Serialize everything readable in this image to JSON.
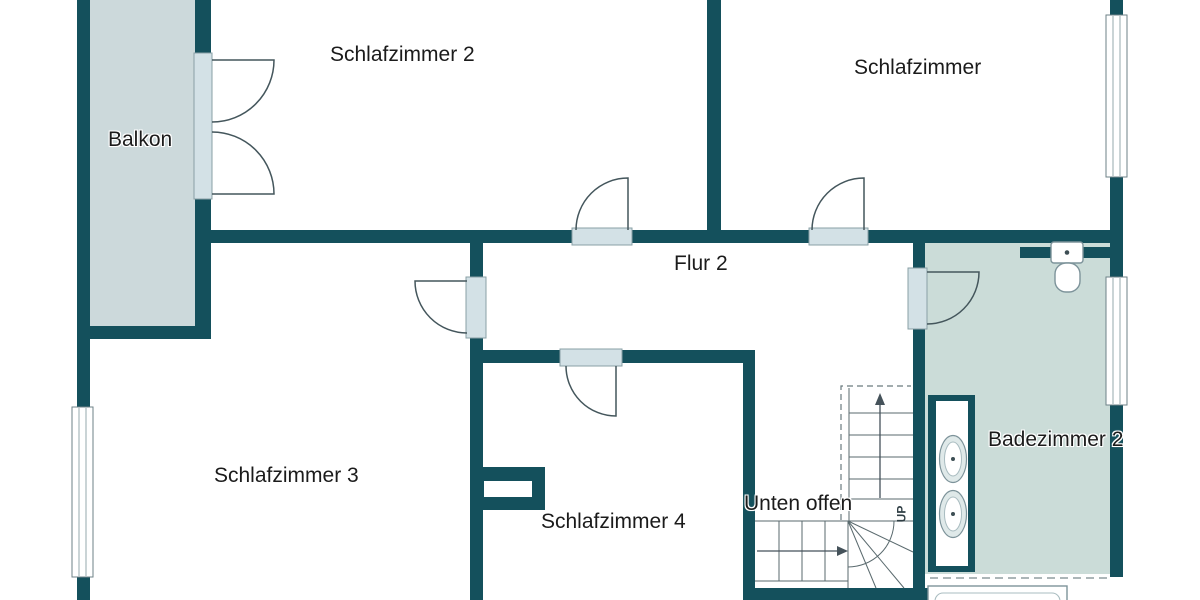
{
  "title": "Obergeschoss Grundriss (Ausschnitt)",
  "rooms": {
    "balkon": {
      "label": "Balkon"
    },
    "schlafzimmer2": {
      "label": "Schlafzimmer 2"
    },
    "schlafzimmer": {
      "label": "Schlafzimmer"
    },
    "flur2": {
      "label": "Flur 2"
    },
    "schlafzimmer3": {
      "label": "Schlafzimmer 3"
    },
    "schlafzimmer4": {
      "label": "Schlafzimmer 4"
    },
    "badezimmer2": {
      "label": "Badezimmer 2"
    }
  },
  "annotations": {
    "unten_offen": {
      "label": "Unten offen"
    },
    "stairs_direction": {
      "label": "UP"
    }
  },
  "fixtures": [
    "staircase",
    "toilet",
    "washbasin",
    "washbasin",
    "bathtub",
    "chimney-shaft",
    "balcony-double-door"
  ],
  "colors": {
    "wall": "#14505c",
    "balcony_fill": "#ccd9db",
    "bath_fill": "#cbdcd8",
    "jamb_fill": "#d3e1e6",
    "door_line": "#44565c",
    "stair_line": "#5a6a6e",
    "dash_line": "#6a7a7e",
    "fixture_line": "#7d939a",
    "window_border": "#6e8287",
    "window_pane": "#95a8ac",
    "text": "#1b1b1b"
  }
}
